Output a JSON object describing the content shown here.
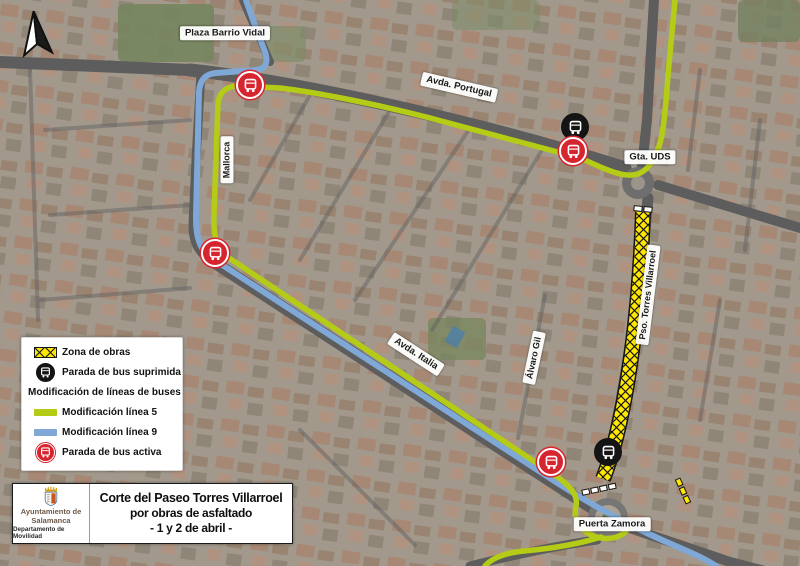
{
  "map": {
    "street_labels": {
      "plaza_barrio_vidal": "Plaza Barrio Vidal",
      "avda_portugal": "Avda. Portugal",
      "gta_uds": "Gta. UDS",
      "mallorca": "Mallorca",
      "avda_italia": "Avda. Italia",
      "alvaro_gil": "Álvaro Gil",
      "pso_torres_villarroel": "Pso. Torres Villarroel",
      "puerta_zamora": "Puerta Zamora"
    },
    "colors": {
      "line5_green": "#b5cc16",
      "line9_blue": "#7fa8d7",
      "works_yellow": "#ffe800",
      "stop_active_red": "#d6252e",
      "stop_removed_black": "#141414"
    }
  },
  "legend": {
    "zona_obras": "Zona de obras",
    "parada_suprimida": "Parada de bus suprimida",
    "modificacion_header": "Modificación de líneas de buses",
    "linea5": "Modificación línea 5",
    "linea9": "Modificación línea 9",
    "parada_activa": "Parada de bus activa"
  },
  "title_box": {
    "line1": "Corte del Paseo Torres Villarroel",
    "line2": "por obras de asfaltado",
    "line3": "- 1 y 2 de abril -",
    "org_line1": "Ayuntamiento de",
    "org_line2": "Salamanca",
    "org_line3": "Departamento de Movilidad"
  }
}
